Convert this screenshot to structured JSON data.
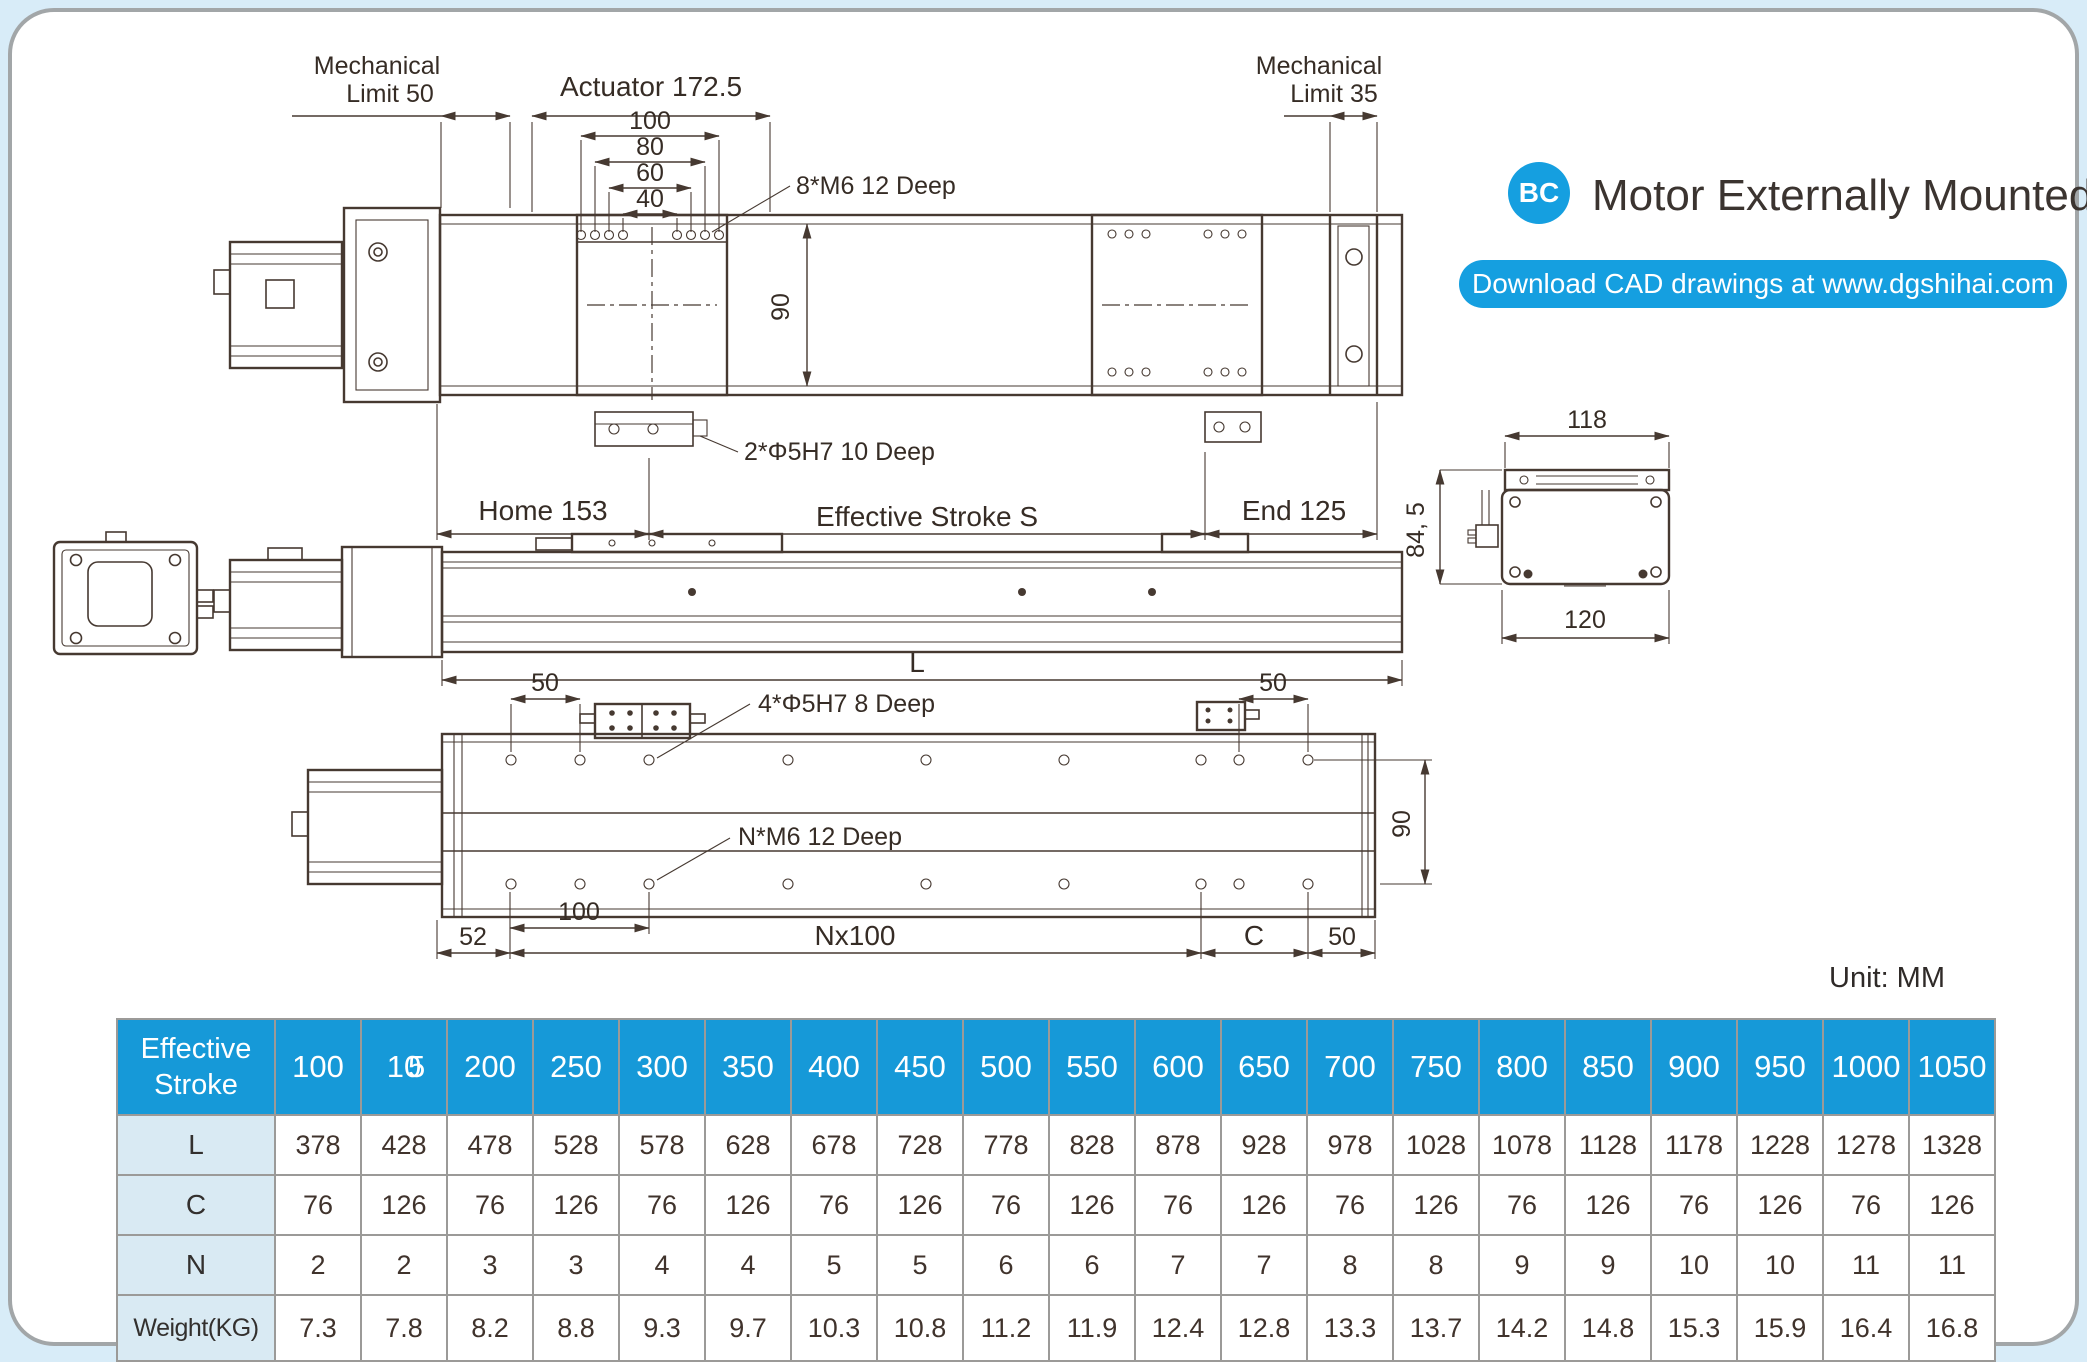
{
  "colors": {
    "accent": "#159fe0",
    "table_header_blue": "#1699d8",
    "row_label_bg": "#d9eaf3",
    "drawing_line": "#463931",
    "grid_gray": "#9b9a98"
  },
  "header": {
    "badge": "BC",
    "title": "Motor Externally Mounted",
    "download_button": "Download CAD drawings at www.dgshihai.com"
  },
  "unit_label": "Unit: MM",
  "top_view": {
    "mech_limit_left_line1": "Mechanical",
    "mech_limit_left_line2": "Limit 50",
    "actuator_dim": "Actuator 172.5",
    "dim_100": "100",
    "dim_80": "80",
    "dim_60": "60",
    "dim_40": "40",
    "label_8m6": "8*M6 12 Deep",
    "dim_90": "90",
    "label_2phi": "2*Φ5H7 10 Deep",
    "home": "Home 153",
    "stroke": "Effective Stroke S",
    "end": "End 125",
    "mech_limit_right_line1": "Mechanical",
    "mech_limit_right_line2": "Limit 35"
  },
  "side_view": {
    "dim_L": "L"
  },
  "end_view": {
    "dim_118": "118",
    "dim_845": "84, 5",
    "dim_120": "120"
  },
  "bottom_view": {
    "dim_50_left": "50",
    "label_4phi": "4*Φ5H7  8 Deep",
    "dim_50_right": "50",
    "label_nm6": "N*M6  12 Deep",
    "dim_90": "90",
    "dim_52": "52",
    "dim_100": "100",
    "dim_nx100": "Nx100",
    "dim_c": "C",
    "dim_50_bottom": "50"
  },
  "table": {
    "corner_line1": "Effective",
    "corner_line2": "Stroke",
    "columns": [
      {
        "label": "100"
      },
      {
        "label": "150",
        "glitch": true
      },
      {
        "label": "200"
      },
      {
        "label": "250"
      },
      {
        "label": "300"
      },
      {
        "label": "350"
      },
      {
        "label": "400"
      },
      {
        "label": "450"
      },
      {
        "label": "500"
      },
      {
        "label": "550"
      },
      {
        "label": "600"
      },
      {
        "label": "650"
      },
      {
        "label": "700"
      },
      {
        "label": "750"
      },
      {
        "label": "800"
      },
      {
        "label": "850"
      },
      {
        "label": "900"
      },
      {
        "label": "950"
      },
      {
        "label": "1000"
      },
      {
        "label": "1050"
      }
    ],
    "rows": [
      {
        "label": "L",
        "values": [
          "378",
          "428",
          "478",
          "528",
          "578",
          "628",
          "678",
          "728",
          "778",
          "828",
          "878",
          "928",
          "978",
          "1028",
          "1078",
          "1128",
          "1178",
          "1228",
          "1278",
          "1328"
        ]
      },
      {
        "label": "C",
        "values": [
          "76",
          "126",
          "76",
          "126",
          "76",
          "126",
          "76",
          "126",
          "76",
          "126",
          "76",
          "126",
          "76",
          "126",
          "76",
          "126",
          "76",
          "126",
          "76",
          "126"
        ]
      },
      {
        "label": "N",
        "values": [
          "2",
          "2",
          "3",
          "3",
          "4",
          "4",
          "5",
          "5",
          "6",
          "6",
          "7",
          "7",
          "8",
          "8",
          "9",
          "9",
          "10",
          "10",
          "11",
          "11"
        ]
      },
      {
        "label": "Weight(KG)",
        "tall": true,
        "small": true,
        "values": [
          "7.3",
          "7.8",
          "8.2",
          "8.8",
          "9.3",
          "9.7",
          "10.3",
          "10.8",
          "11.2",
          "11.9",
          "12.4",
          "12.8",
          "13.3",
          "13.7",
          "14.2",
          "14.8",
          "15.3",
          "15.9",
          "16.4",
          "16.8"
        ]
      }
    ]
  }
}
